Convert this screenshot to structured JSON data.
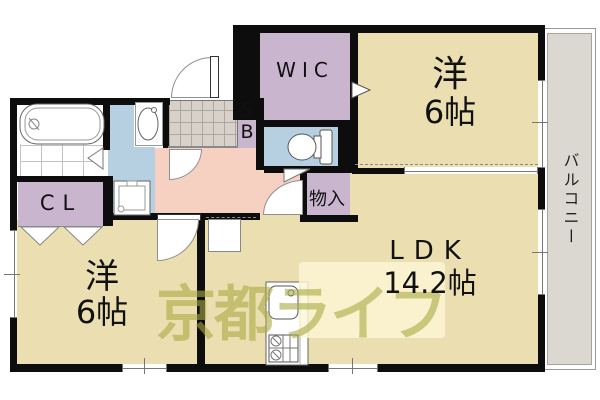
{
  "floorplan": {
    "watermark_text": "京都ライフ",
    "labels": {
      "wic": "WIC",
      "shoebox_line1": "S",
      "shoebox_line2": "B",
      "closet": "CL",
      "storage": "物入",
      "balcony": "バルコニー"
    },
    "rooms": {
      "western_top": {
        "name": "洋",
        "size": "6帖"
      },
      "western_bottom": {
        "name": "洋",
        "size": "6帖"
      },
      "ldk": {
        "name": "LDK",
        "size": "14.2帖"
      }
    },
    "colors": {
      "room": "#ebdfb2",
      "closet": "#c9b5ce",
      "wet": "#b7d0e1",
      "hall": "#f6d0c1",
      "balcony": "#dbd7d1",
      "wall": "#0d0d0d",
      "tile": "#d7d1ca",
      "watermark": "#a8aa42"
    }
  }
}
